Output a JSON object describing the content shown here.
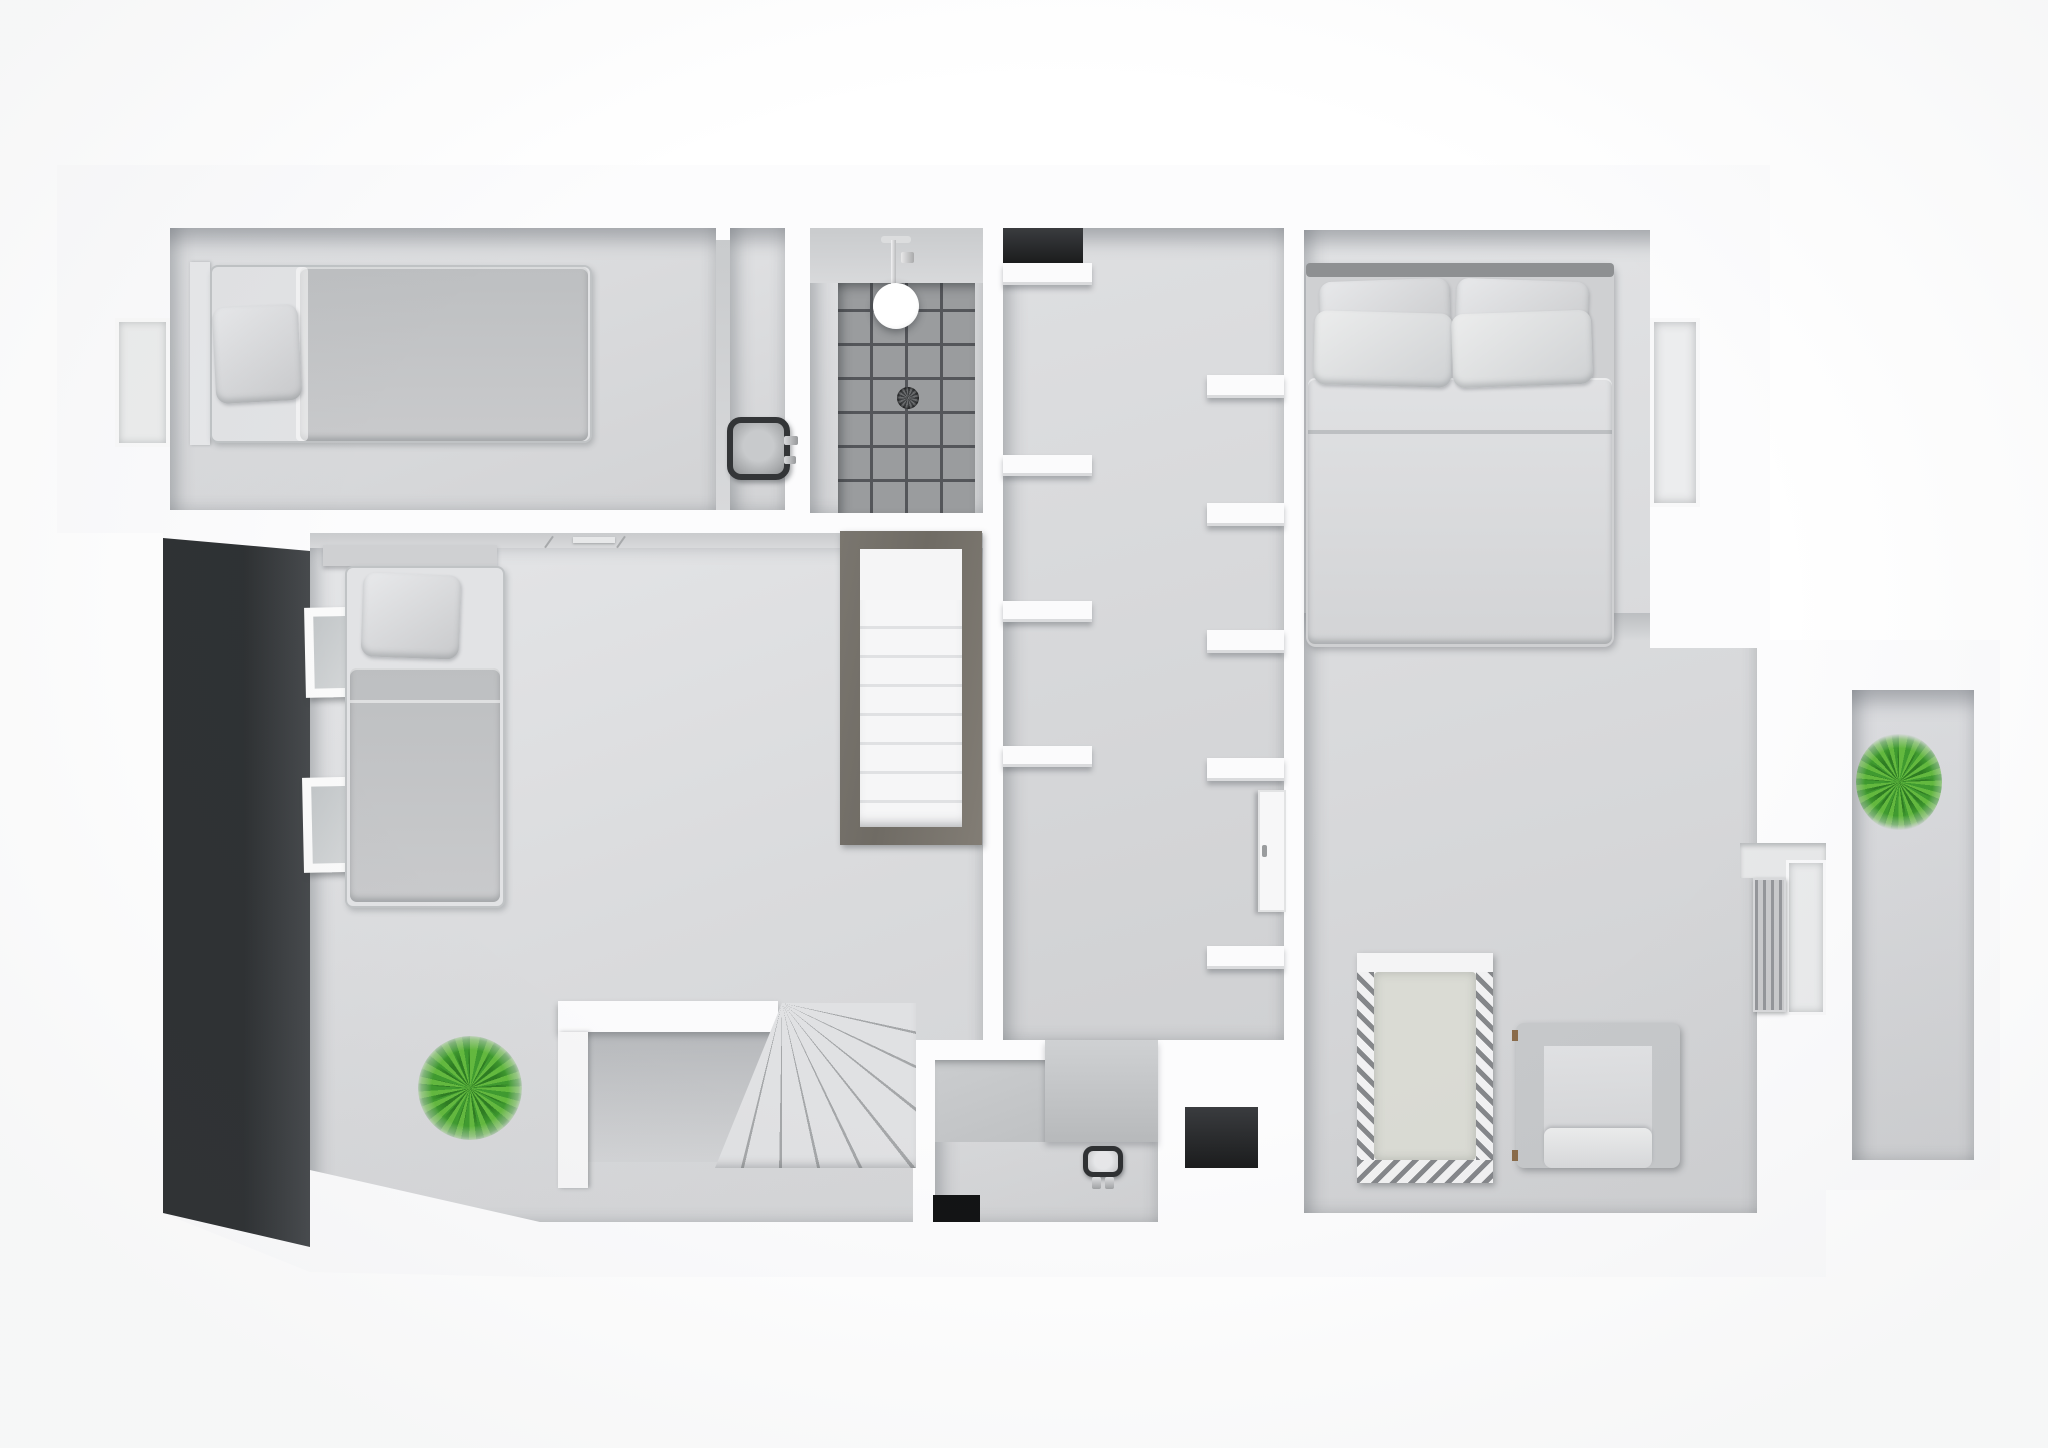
{
  "scene": {
    "kind": "3d-floorplan-render",
    "view": "top-down dollhouse view, monochrome white & gray, no text",
    "floor_label": "Upper floor plan render",
    "rooms": [
      {
        "id": "bedroom-1",
        "label": "single bedroom (top left)",
        "furniture": [
          "single-bed",
          "wall-window"
        ]
      },
      {
        "id": "shower-room",
        "label": "shower room (top middle)",
        "furniture": [
          "walk-in-shower",
          "ceiling-shower-head",
          "floor-drain",
          "washbasin"
        ]
      },
      {
        "id": "hallway-closet",
        "label": "hallway with closet shelving",
        "furniture": [
          "wall-shelves-left",
          "wall-shelves-right",
          "closet-cabinet-door",
          "dark-doorway"
        ]
      },
      {
        "id": "living-room",
        "label": "large room / second bedroom (left)",
        "furniture": [
          "single-bed-2",
          "headboard-shelf",
          "two-wall-frames",
          "dark-accent-wall",
          "console-desk",
          "potted-plant",
          "winder-stairs",
          "straight-staircase"
        ]
      },
      {
        "id": "master-bedroom",
        "label": "master bedroom with nursery (right)",
        "furniture": [
          "double-bed",
          "four-pillows",
          "baby-crib",
          "cube-armchair",
          "radiator",
          "window-niche"
        ]
      },
      {
        "id": "wc",
        "label": "small wc (bottom middle)",
        "furniture": [
          "toilet"
        ]
      },
      {
        "id": "balcony",
        "label": "balcony (right)",
        "furniture": [
          "potted-plant-2"
        ]
      }
    ],
    "shelf_counts": {
      "hallway_left": 4,
      "hallway_right": 5
    },
    "stair_treads_straight": 8,
    "stair_treads_winder": 7
  },
  "colors": {
    "page_bg": "#ffffff",
    "plate": "#fcfcfd",
    "wall_face": "#c9cbcd",
    "floor": "#e0e1e3",
    "floor_dark": "#d2d3d5",
    "accent_dark_1": "#2e3133",
    "accent_dark_2": "#474a4d",
    "tile": "#9a9c9e",
    "grout": "#54565a",
    "fabric_light": "#e2e3e5",
    "fabric_mid": "#c9cacc",
    "fabric_dark": "#bdbfc1",
    "stair_frame": "#6f6b64",
    "plant_dark": "#2e7d22",
    "plant_mid": "#3f9b2f",
    "plant_light": "#63b93e",
    "fixture_dark": "#333537",
    "opening_dark": "#1b1c1d"
  }
}
